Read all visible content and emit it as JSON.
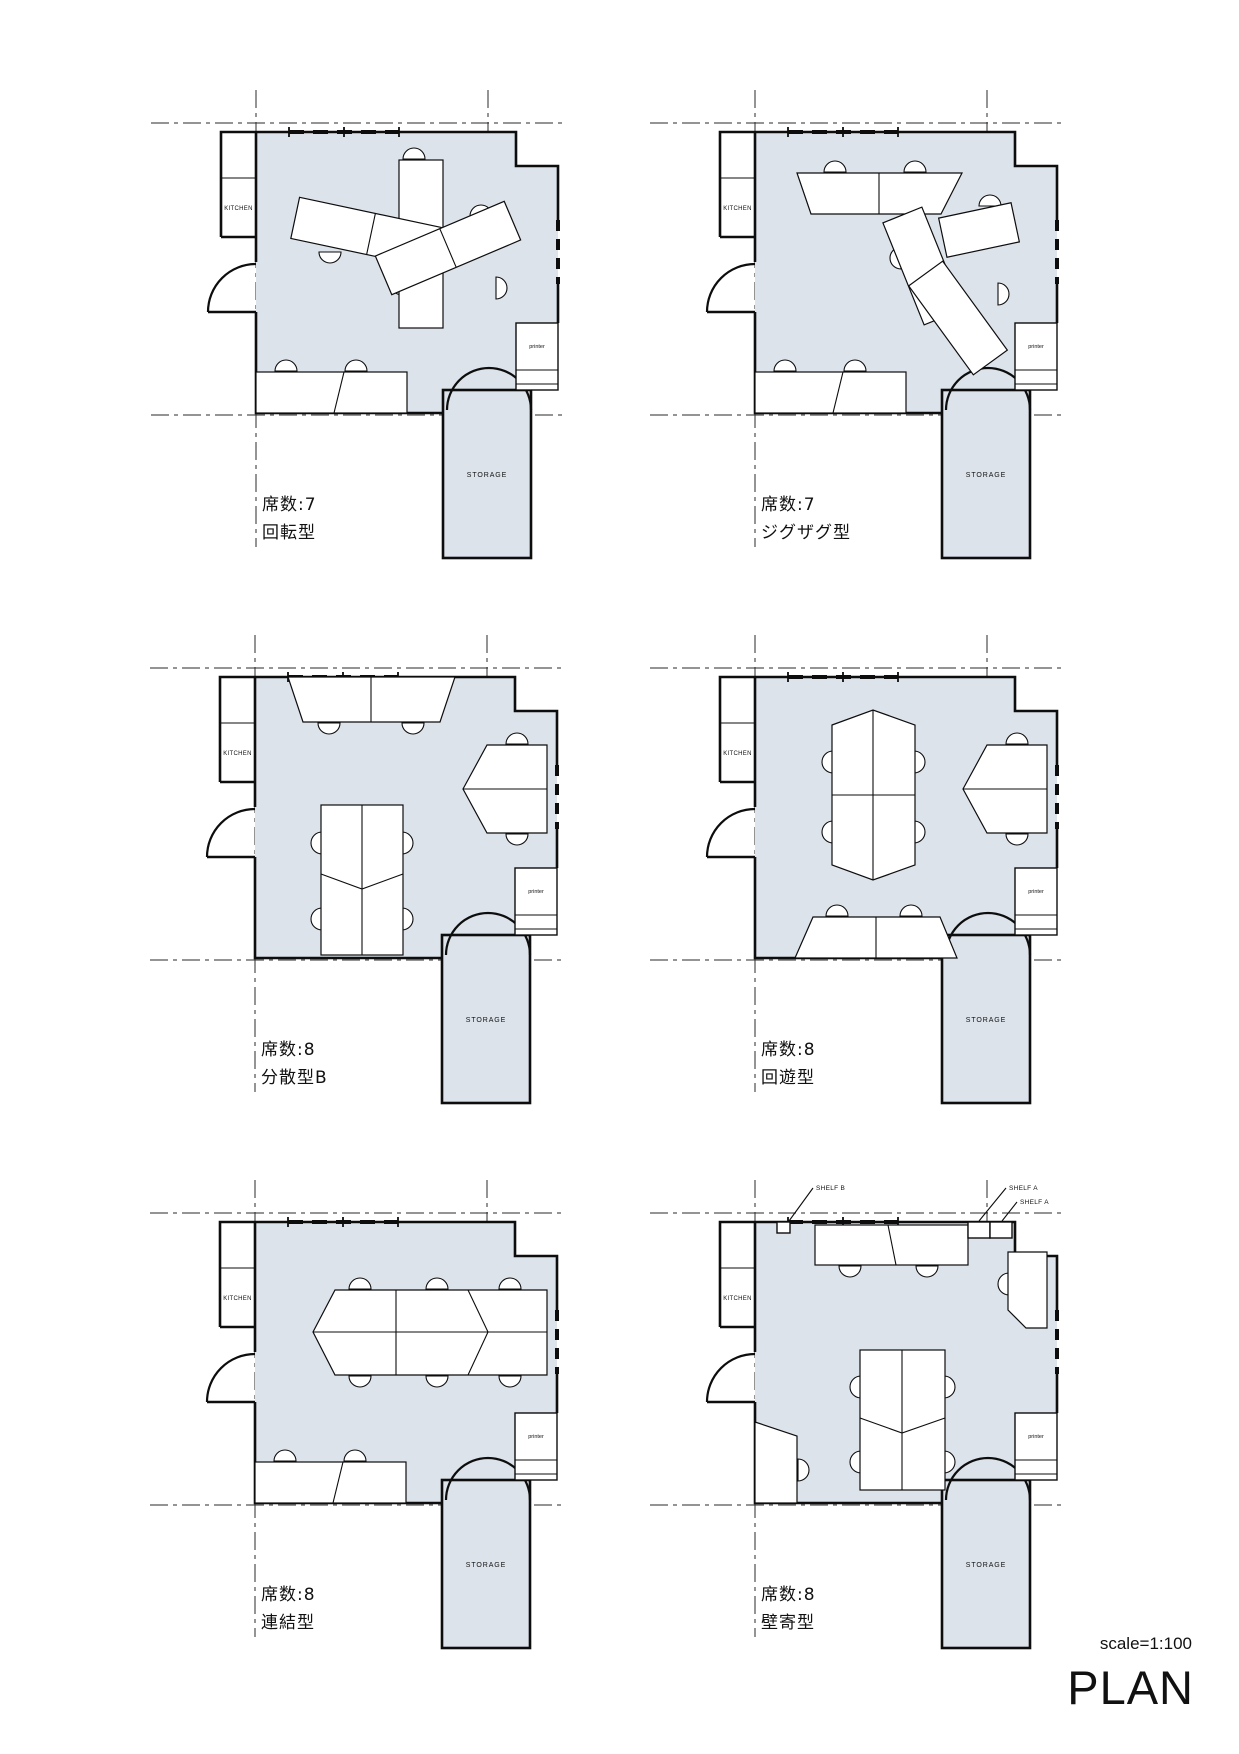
{
  "document": {
    "scale_label": "scale=1:100",
    "title": "PLAN"
  },
  "labels": {
    "kitchen": "KITCHEN",
    "storage": "STORAGE",
    "printer": "printer",
    "shelf_a": "SHELF A",
    "shelf_b": "SHELF B"
  },
  "colors": {
    "floor": "#dce3ea",
    "line": "#0d0d0d"
  },
  "plans": [
    {
      "seats": "席数:7",
      "type": "回転型"
    },
    {
      "seats": "席数:7",
      "type": "ジグザグ型"
    },
    {
      "seats": "席数:8",
      "type": "分散型B"
    },
    {
      "seats": "席数:8",
      "type": "回遊型"
    },
    {
      "seats": "席数:8",
      "type": "連結型"
    },
    {
      "seats": "席数:8",
      "type": "壁寄型"
    }
  ]
}
